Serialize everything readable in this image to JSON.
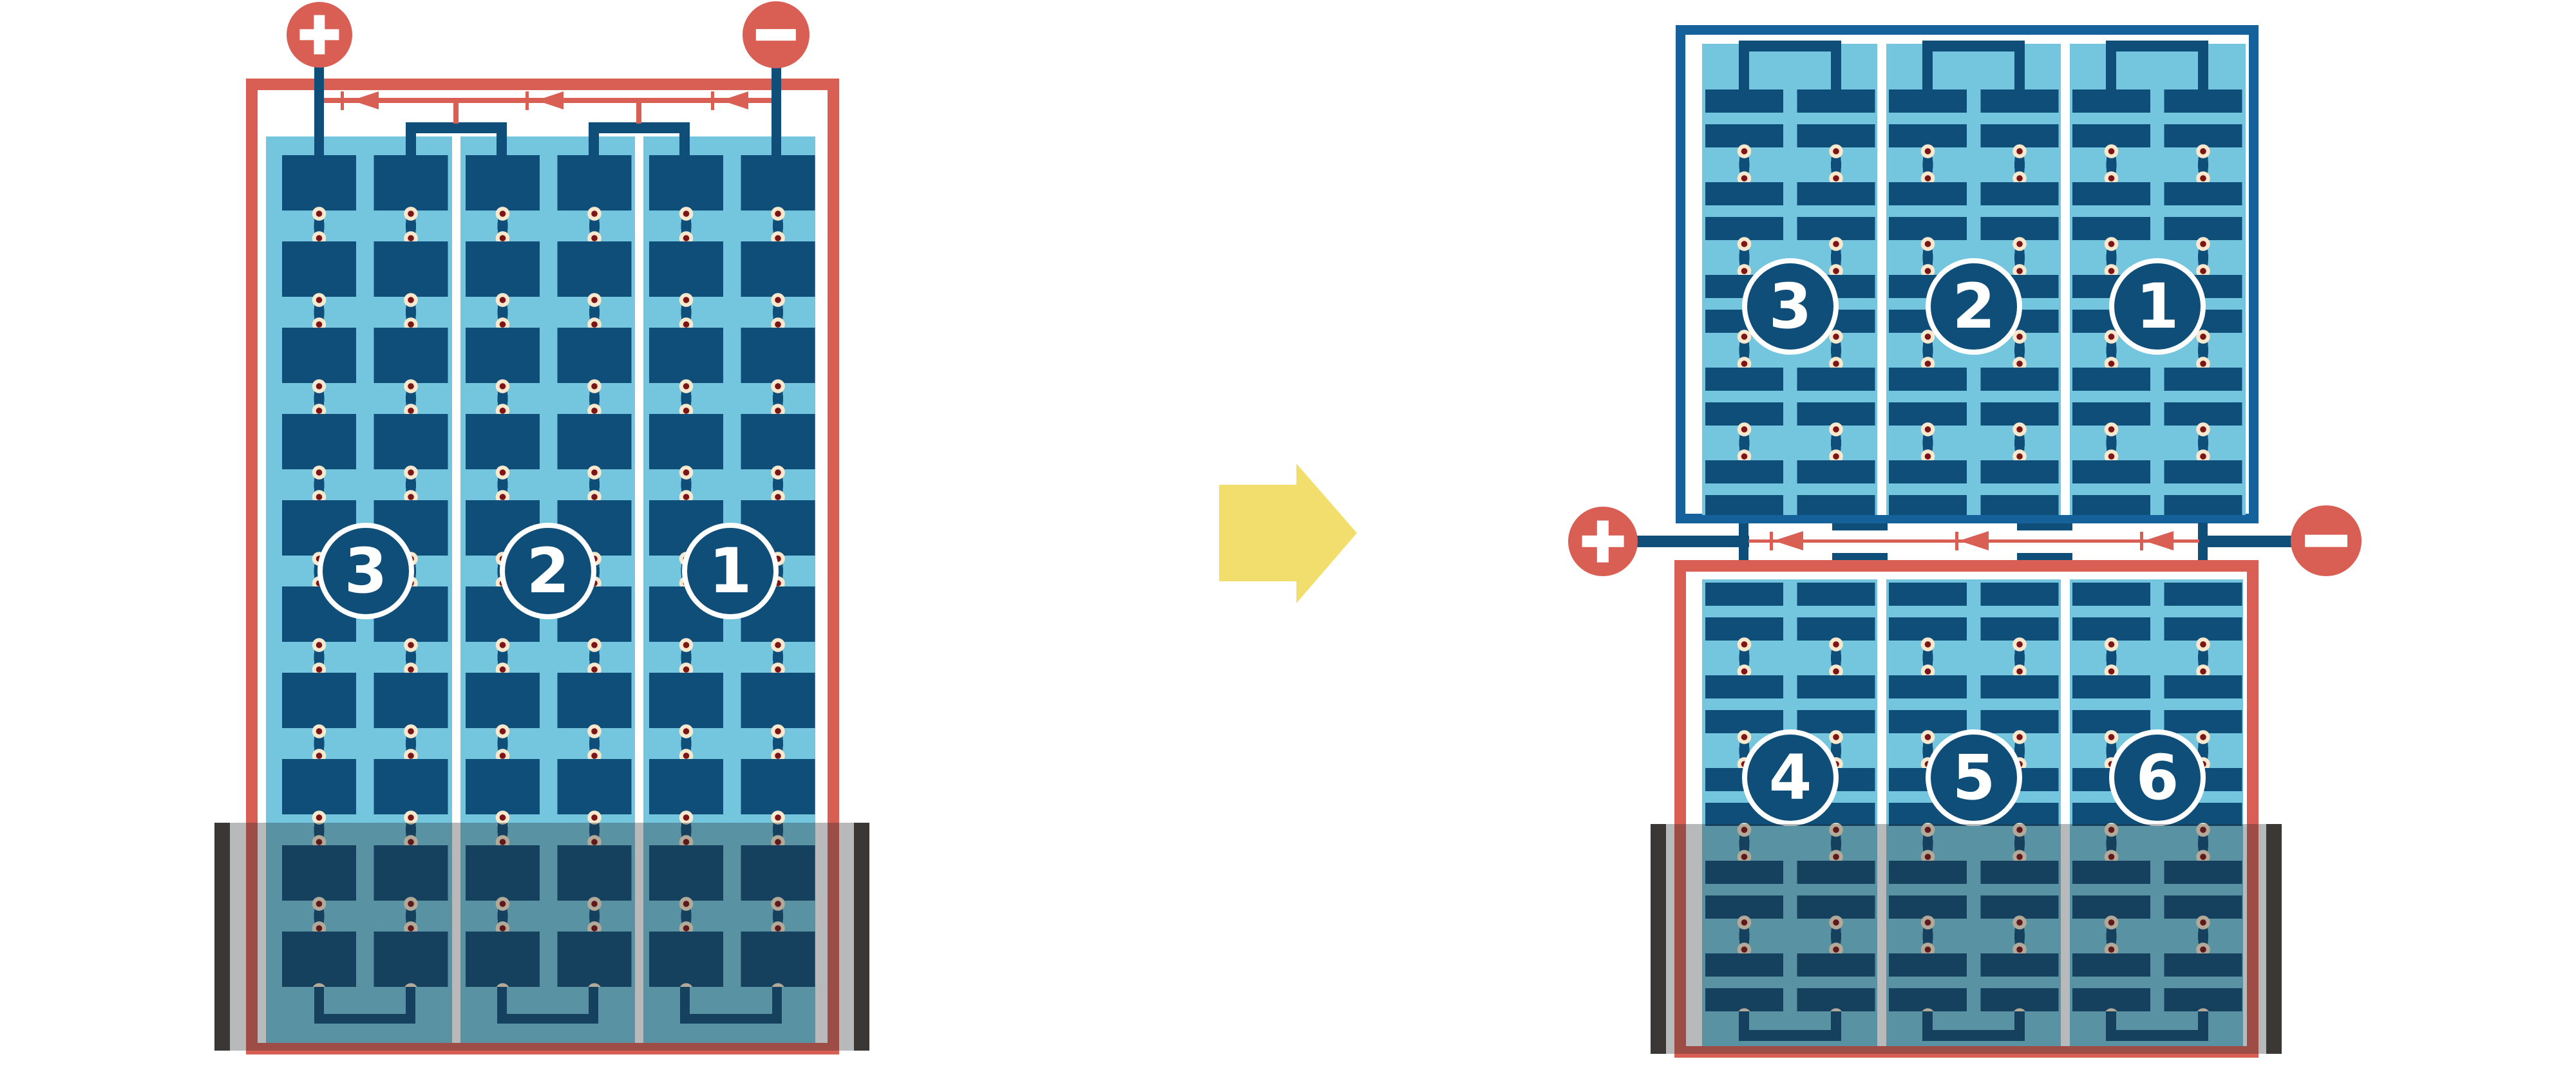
{
  "colors": {
    "red": "#D95F55",
    "dark_blue": "#0F4E78",
    "frame_blue": "#15619B",
    "light_blue": "#74C6DE",
    "cream": "#F7E8CE",
    "maroon": "#7D1416",
    "yellow": "#F2DE6D",
    "bar_dark": "#3B3735",
    "shade": "rgba(33,36,40,0.32)"
  },
  "left_module": {
    "strings": [
      {
        "label": "3"
      },
      {
        "label": "2"
      },
      {
        "label": "1"
      }
    ],
    "terminals": {
      "positive": "+",
      "negative": "−"
    }
  },
  "right_module": {
    "top_half": {
      "strings": [
        {
          "label": "3"
        },
        {
          "label": "2"
        },
        {
          "label": "1"
        }
      ]
    },
    "bottom_half": {
      "strings": [
        {
          "label": "4"
        },
        {
          "label": "5"
        },
        {
          "label": "6"
        }
      ]
    },
    "terminals": {
      "positive": "+",
      "negative": "−"
    }
  }
}
